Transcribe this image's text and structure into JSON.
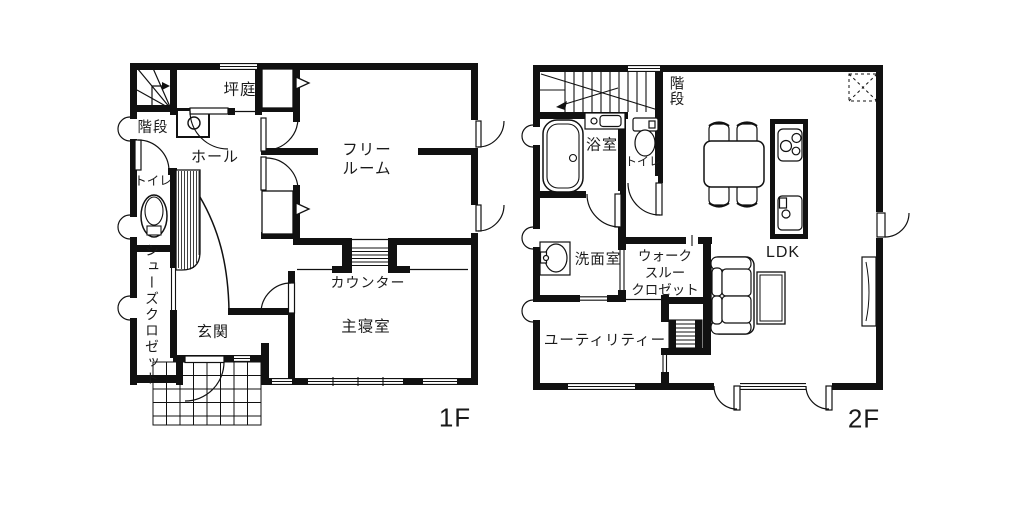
{
  "meta": {
    "ink": "#111111",
    "background": "#ffffff",
    "drawing_type": "floor-plan"
  },
  "floors": [
    {
      "tag": "1F",
      "rooms": [
        {
          "id": "tsuboniwa",
          "label": "坪庭"
        },
        {
          "id": "kaidan",
          "label": "階段"
        },
        {
          "id": "hall",
          "label": "ホール"
        },
        {
          "id": "toilet",
          "label": "トイレ"
        },
        {
          "id": "shoes-closet",
          "label": "シューズクロゼット"
        },
        {
          "id": "genkan",
          "label": "玄関"
        },
        {
          "id": "free-room",
          "label": "フリー\nルーム"
        },
        {
          "id": "counter",
          "label": "カウンター"
        },
        {
          "id": "master-bedroom",
          "label": "主寝室"
        }
      ]
    },
    {
      "tag": "2F",
      "rooms": [
        {
          "id": "kaidan",
          "label": "階段"
        },
        {
          "id": "bathroom",
          "label": "浴室"
        },
        {
          "id": "toilet",
          "label": "トイレ"
        },
        {
          "id": "washroom",
          "label": "洗面室"
        },
        {
          "id": "walkthrough-closet",
          "label": "ウォーク\nスルー\nクロゼット"
        },
        {
          "id": "utility",
          "label": "ユーティリティー"
        },
        {
          "id": "ldk",
          "label": "LDK"
        }
      ]
    }
  ]
}
